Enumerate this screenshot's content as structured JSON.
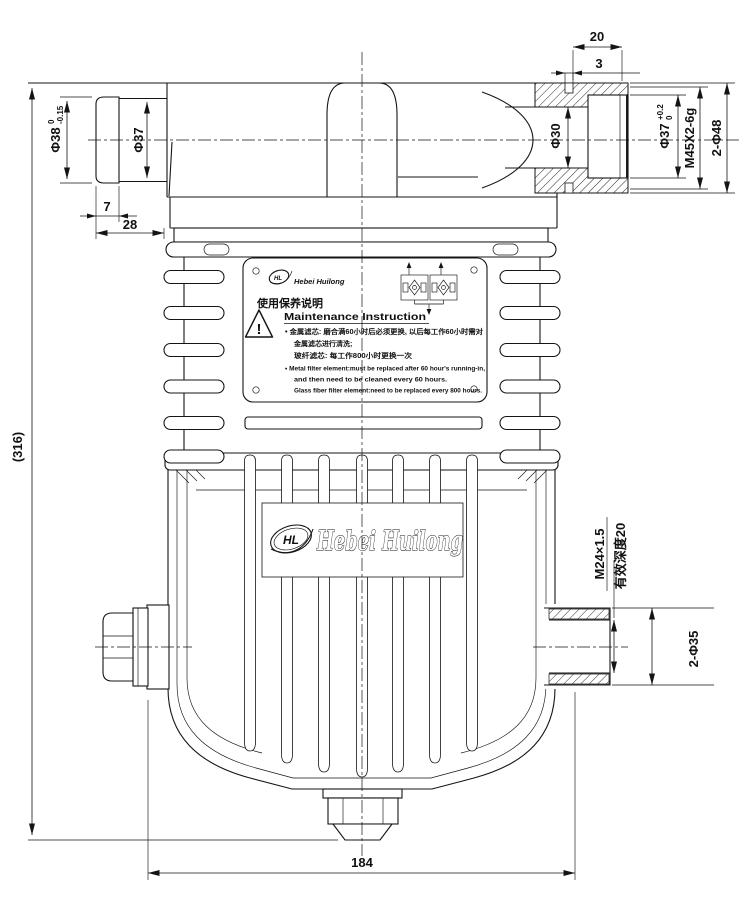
{
  "drawing": {
    "brand": "Hebei Huilong",
    "monogram": "HL"
  },
  "dims": {
    "overall_height": "(316)",
    "overall_width": "184",
    "spigot_od": "Φ38",
    "spigot_od_tol_up": "0",
    "spigot_od_tol_dn": "-0.15",
    "spigot_body_od": "Φ37",
    "cap_width": "7",
    "spigot_length": "28",
    "port_length": "20",
    "groove_width": "3",
    "port_bore": "Φ30",
    "thread_bore": "Φ37",
    "thread_bore_tol_up": "+0.2",
    "thread_bore_tol_dn": "0",
    "port_thread": "M45X2-6g",
    "port_hex": "2-Φ48",
    "outlet_thread": "M24×1.5",
    "outlet_depth": "有效深度20",
    "outlet_ports": "2-Φ35"
  },
  "nameplate": {
    "brand": "Hebei Huilong",
    "title_zh": "使用保养说明",
    "title_en": "Maintenance Instruction",
    "zh_line1": "• 金属滤芯: 磨合满60小时后必须更换, 以后每工作60小时需对",
    "zh_line2": "金属滤芯进行清洗;",
    "zh_line3": "玻纤滤芯: 每工作800小时更换一次",
    "en_line1": "• Metal filter element:must be replaced after 60 hour's running-in,",
    "en_line2": "and then need to be cleaned every 60 hours.",
    "en_line3": "Glass fiber filter element:need to be replaced every 800 hours.",
    "warning_mark": "!"
  },
  "body_logo": {
    "brand": "Hebei Huilong",
    "monogram": "HL"
  }
}
